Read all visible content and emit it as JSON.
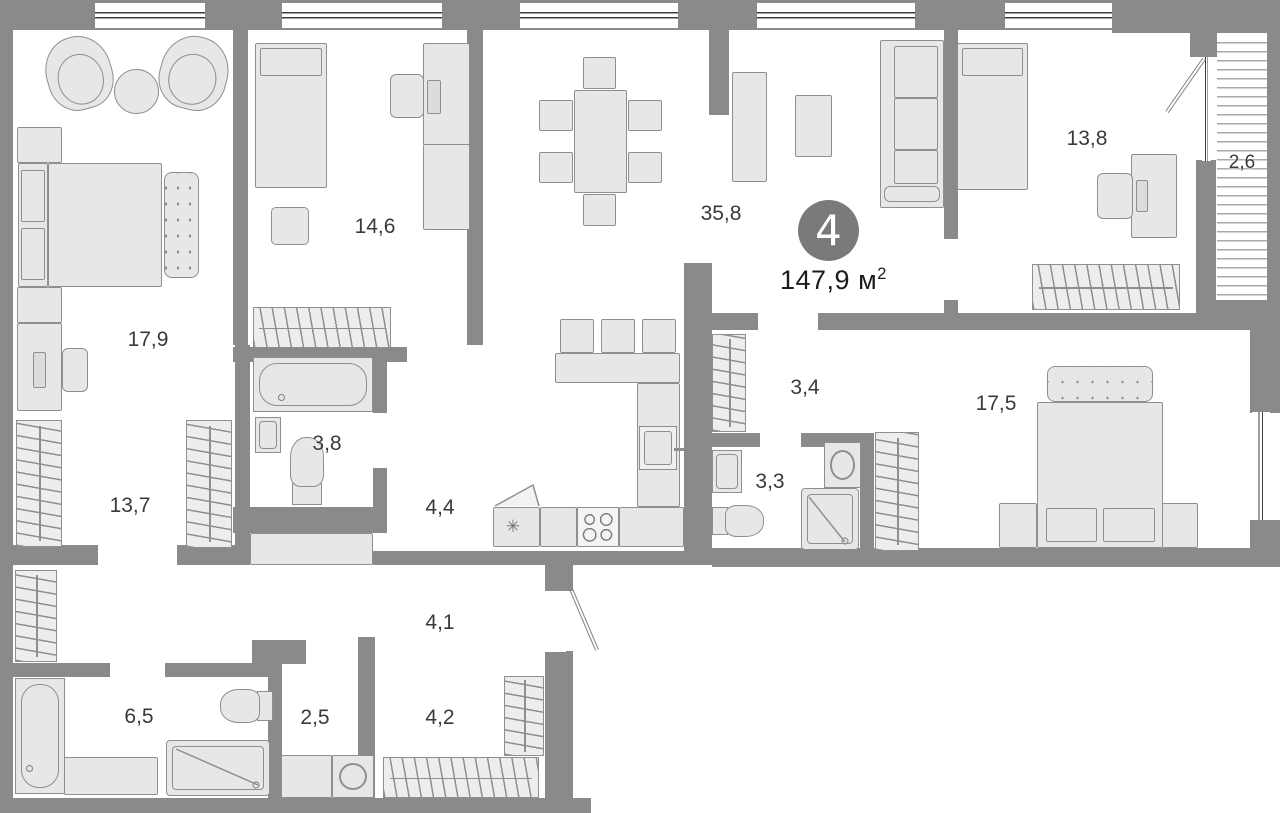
{
  "plan": {
    "title": "apartment-floor-plan",
    "badge": {
      "rooms_count": "4",
      "area_value": "147,9",
      "area_unit": "м",
      "area_sup": "2"
    },
    "rooms": [
      {
        "id": "bedroom-main",
        "area": "17,9"
      },
      {
        "id": "bedroom-2",
        "area": "14,6"
      },
      {
        "id": "living-dining",
        "area": "35,8"
      },
      {
        "id": "bedroom-3",
        "area": "13,8"
      },
      {
        "id": "balcony",
        "area": "2,6"
      },
      {
        "id": "dressing-room",
        "area": "13,7"
      },
      {
        "id": "bathroom-1",
        "area": "3,8"
      },
      {
        "id": "kitchen",
        "area": "4,4"
      },
      {
        "id": "hall",
        "area": "3,4"
      },
      {
        "id": "wc",
        "area": "3,3"
      },
      {
        "id": "bedroom-4",
        "area": "17,5"
      },
      {
        "id": "corridor",
        "area": "4,1"
      },
      {
        "id": "bathroom-2",
        "area": "6,5"
      },
      {
        "id": "laundry",
        "area": "2,5"
      },
      {
        "id": "hallway",
        "area": "4,2"
      }
    ],
    "icons": {
      "fridge_snowflake": "✳"
    },
    "colors": {
      "background": "#ffffff",
      "wall": "#8a8a8a",
      "furniture_fill": "#e7e7e7",
      "furniture_stroke": "#8f8f8f",
      "hatch_bg": "#ededed",
      "window_line": "#3c3c3c",
      "balcony_line": "#a9a9a9",
      "badge_bg": "#7a7a7a",
      "badge_text": "#ffffff",
      "label_color": "#3a3a3a"
    }
  }
}
